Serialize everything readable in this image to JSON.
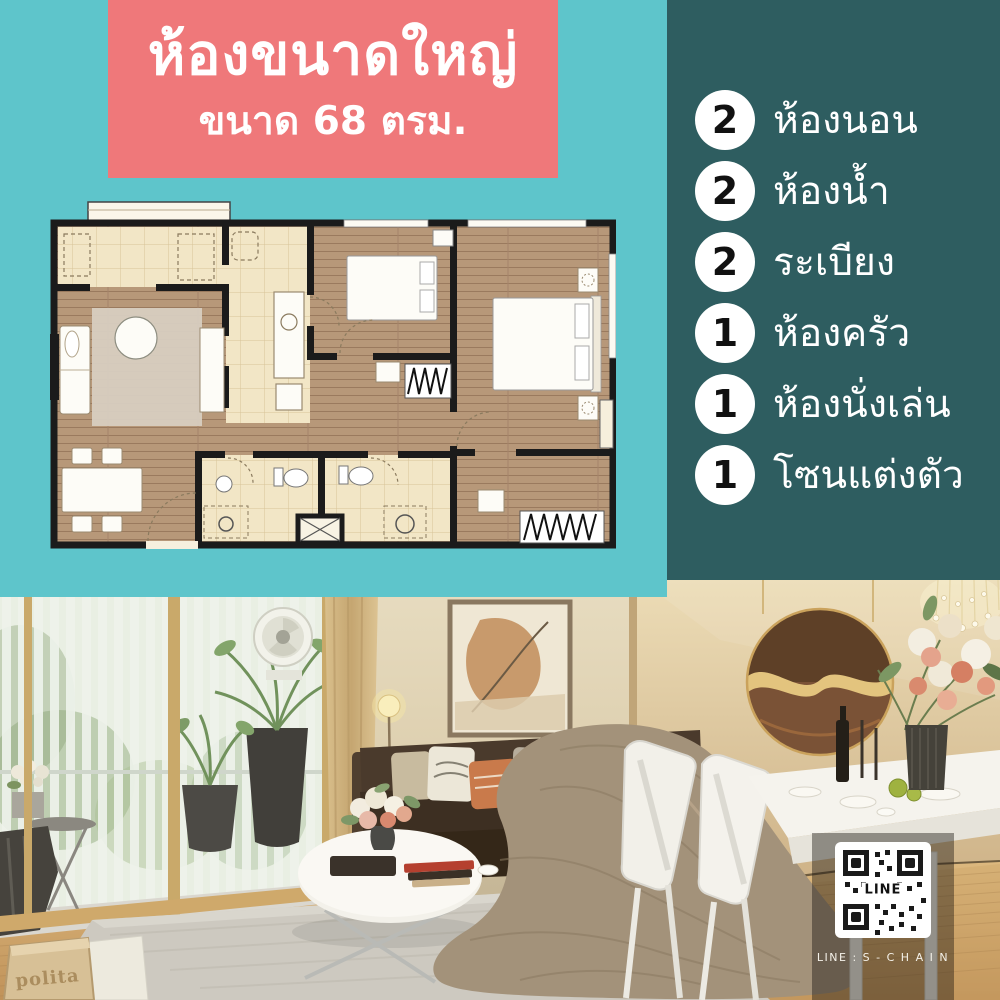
{
  "banner": {
    "title": "ห้องขนาดใหญ่",
    "subtitle": "ขนาด 68 ตรม."
  },
  "features": {
    "items": [
      {
        "count": "2",
        "label": "ห้องนอน"
      },
      {
        "count": "2",
        "label": "ห้องน้ำ"
      },
      {
        "count": "2",
        "label": "ระเบียง"
      },
      {
        "count": "1",
        "label": "ห้องครัว"
      },
      {
        "count": "1",
        "label": "ห้องนั่งเล่น"
      },
      {
        "count": "1",
        "label": "โซนแต่งตัว"
      }
    ]
  },
  "contact": {
    "qr_center_label": "LINE",
    "caption": "LINE : S - C H A I N"
  },
  "photo": {
    "magazine_label": "polita"
  },
  "colors": {
    "teal_bg": "#5ec5cb",
    "panel_bg": "#2e5d60",
    "banner_bg": "#ef787a",
    "text_on_dark": "#ffffff",
    "badge_bg": "#ffffff",
    "badge_text": "#111111",
    "plan_wall": "#1b1b1b",
    "plan_wood": "#b79879",
    "plan_cream": "#f2e6c6"
  }
}
